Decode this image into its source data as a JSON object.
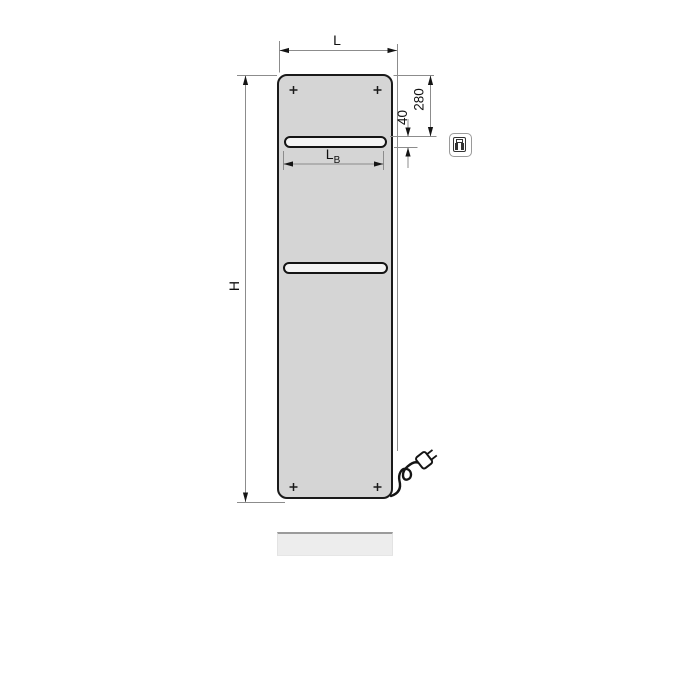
{
  "drawing": {
    "type": "technical-dimension-drawing",
    "subject": "flat panel electric bathroom radiator with towel slots",
    "dimensions": {
      "width_label": "L",
      "height_label": "H",
      "slot_width_label": "L",
      "slot_width_sub": "B",
      "top_to_slot_mm": "280",
      "slot_height_mm": "40"
    },
    "icons": {
      "control_unit": "control-unit-icon",
      "screw_marks": "plus-cross-screw-marks",
      "power_plug": "power-plug-icon"
    },
    "colors": {
      "panel_fill": "#d5d5d5",
      "panel_outline": "#1a1a1a",
      "slot_fill": "#f4f4f4",
      "dimension_line": "#8c8c8c",
      "label_text": "#111111",
      "reflection_fill": "#ededed",
      "reflection_edge": "#9b9b9b"
    }
  }
}
